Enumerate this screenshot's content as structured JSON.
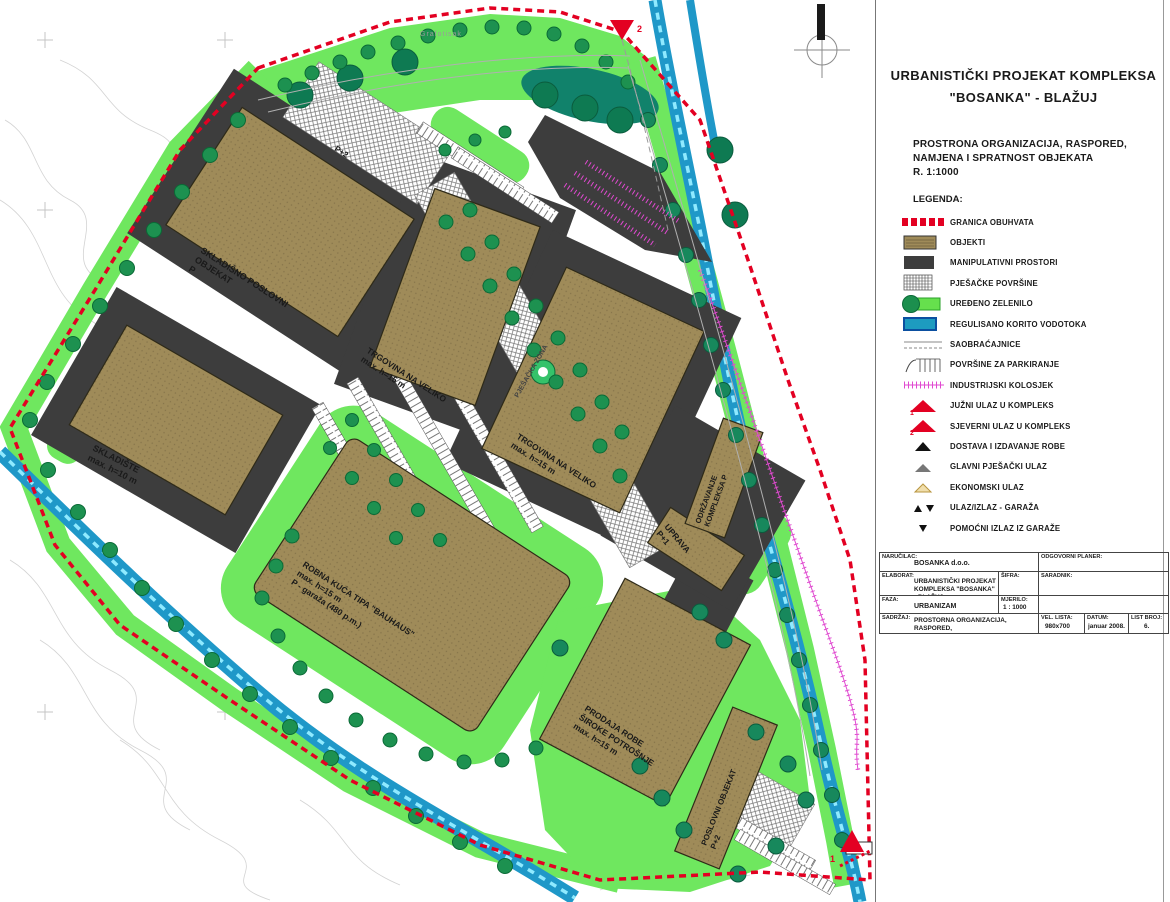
{
  "panel": {
    "title_line1": "URBANISTIČKI PROJEKAT KOMPLEKSA",
    "title_line2": "\"BOSANKA\" - BLAŽUJ",
    "subtitle_line1": "PROSTRONA ORGANIZACIJA, RASPORED,",
    "subtitle_line2": "NAMJENA I SPRATNOST OBJEKATA",
    "subtitle_line3": "R. 1:1000",
    "legend_heading": "LEGENDA:"
  },
  "legend": {
    "items": [
      {
        "type": "granica",
        "label": "GRANICA OBUHVATA"
      },
      {
        "type": "objekti",
        "label": "OBJEKTI"
      },
      {
        "type": "manipulativni",
        "label": "MANIPULATIVNI PROSTORI"
      },
      {
        "type": "pjesacke",
        "label": "PJEŠAČKE POVRŠINE"
      },
      {
        "type": "zelenilo",
        "label": "UREĐENO ZELENILO"
      },
      {
        "type": "korito",
        "label": "REGULISANO KORITO VODOTOKA"
      },
      {
        "type": "saobracajnice",
        "label": "SAOBRAĆAJNICE"
      },
      {
        "type": "parkiranje",
        "label": "POVRŠINE ZA PARKIRANJE"
      },
      {
        "type": "kolosjek",
        "label": "INDUSTRIJSKI KOLOSJEK"
      },
      {
        "type": "ulaz-juzni",
        "label": "JUŽNI ULAZ U KOMPLEKS",
        "number": "1"
      },
      {
        "type": "ulaz-sjeverni",
        "label": "SJEVERNI ULAZ U KOMPLEKS",
        "number": "2"
      },
      {
        "type": "dostava",
        "label": "DOSTAVA I IZDAVANJE ROBE"
      },
      {
        "type": "pjesacki",
        "label": "GLAVNI PJEŠAČKI ULAZ"
      },
      {
        "type": "ekonomski",
        "label": "EKONOMSKI ULAZ"
      },
      {
        "type": "garaza",
        "label": "ULAZ/IZLAZ - GARAŽA"
      },
      {
        "type": "pomocni",
        "label": "POMOĆNI IZLAZ IZ GARAŽE"
      }
    ]
  },
  "titleblock": {
    "narucilac_label": "NARUČILAC:",
    "narucilac_value": "BOSANKA d.o.o.",
    "elaborat_label": "ELABORAT:",
    "elaborat_value_line1": "URBANISTIČKI PROJEKAT",
    "elaborat_value_line2": "KOMPLEKSA \"BOSANKA\" - BLAŽUJ",
    "sifra_label": "ŠIFRA:",
    "faza_label": "FAZA:",
    "faza_value": "URBANIZAM",
    "mjerilo_label": "MJERILO:",
    "mjerilo_value": "1 : 1000",
    "sadrzaj_label": "SADRŽAJ:",
    "sadrzaj_value_line1": "PROSTORNA ORGANIZACIJA, RASPORED,",
    "sadrzaj_value_line2": "NAMJENA I SPRATNOST OBJEKATA",
    "planer_label": "ODGOVORNI PLANER:",
    "saradnik_label": "SARADNIK:",
    "vel_lista_label": "VEL. LISTA:",
    "vel_lista_value": "980x700",
    "datum_label": "DATUM:",
    "datum_value": "januar 2008.",
    "list_broj_label": "LIST BROJ:",
    "list_broj_value": "6."
  },
  "map": {
    "labels": [
      {
        "id": "skladisno",
        "lines": [
          "SKLADIŠNO POSLOVNI",
          "OBJEKAT",
          "P"
        ]
      },
      {
        "id": "p2-top",
        "lines": [
          "P+2"
        ]
      },
      {
        "id": "skladiste",
        "lines": [
          "SKLADIŠTE",
          "max. h=10 m"
        ]
      },
      {
        "id": "trgovina-1",
        "lines": [
          "TRGOVINA NA VELIKO",
          "max. h=15 m"
        ]
      },
      {
        "id": "trgovina-2",
        "lines": [
          "TRGOVINA NA VELIKO",
          "max. h=15 m"
        ]
      },
      {
        "id": "robna-kuca",
        "lines": [
          "ROBNA KUĆA TIPA \"BAUHAUS\"",
          "max. h=15 m",
          "P - garaža (480 p.m.)"
        ]
      },
      {
        "id": "prodaja",
        "lines": [
          "PRODAJA ROBE",
          "ŠIROKE POTROŠNJE",
          "max. h=15 m"
        ]
      },
      {
        "id": "uprava",
        "lines": [
          "UPRAVA",
          "P+1"
        ]
      },
      {
        "id": "odrzavanje",
        "lines": [
          "ODRŽAVANJE",
          "KOMPLEKSA P"
        ]
      },
      {
        "id": "poslovni",
        "lines": [
          "POSLOVNI OBJEKAT",
          "P+2"
        ]
      },
      {
        "id": "pjesacka",
        "lines": [
          "PJEŠAČKA ZONA"
        ]
      },
      {
        "id": "topo",
        "lines": [
          "Grafotisak"
        ]
      }
    ],
    "north_entrance_number": "2",
    "south_entrance_number": "1"
  },
  "colors": {
    "boundary_red": "#e30022",
    "building_tan": "#9f8b59",
    "manipulative_dark": "#3d3d3d",
    "green": "#6fe75f",
    "tree_green": "#1d9150",
    "water_blue": "#1f98c8",
    "rail_magenta": "#e04ad0"
  }
}
